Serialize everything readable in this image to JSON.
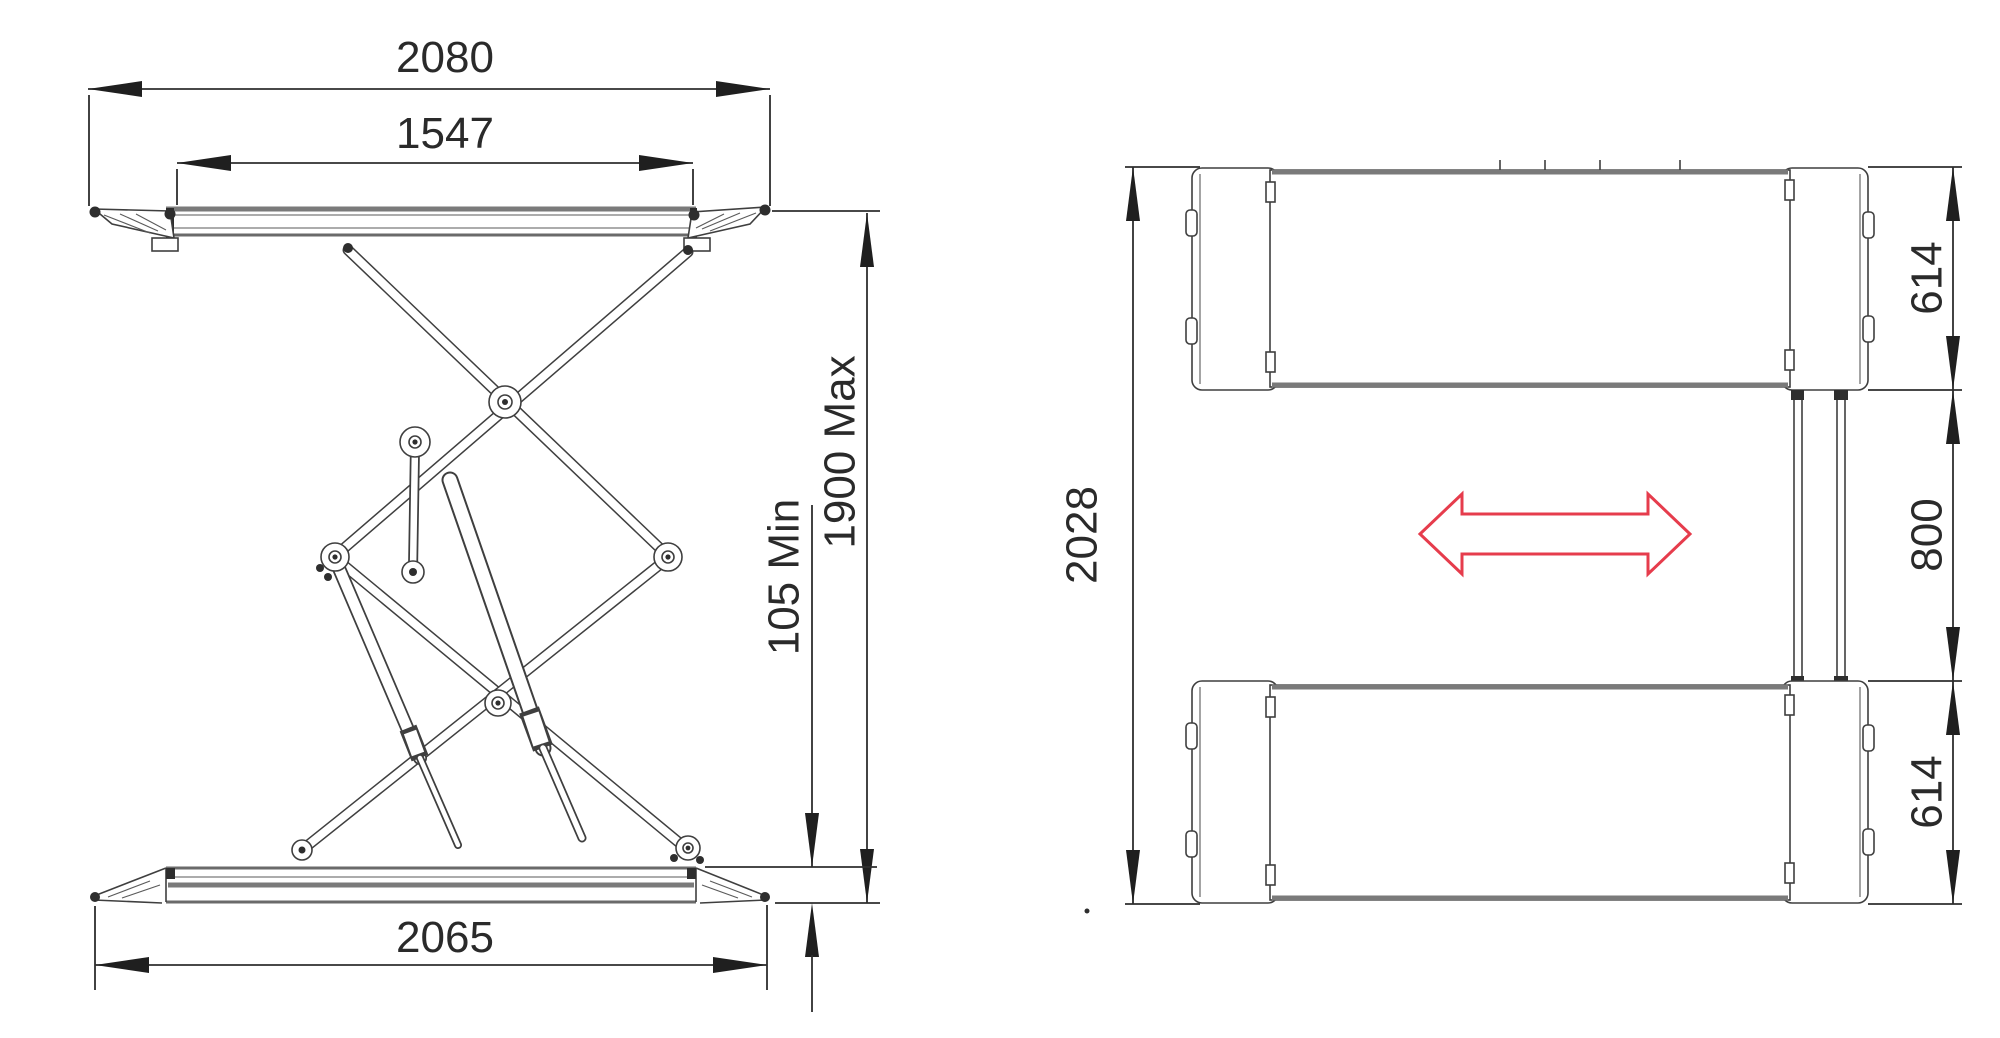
{
  "drawing": {
    "type": "scissor-car-lift-technical-drawing",
    "colors": {
      "line": "#3f3f3f",
      "thick_edge": "#7a7a7a",
      "dimension": "#2e2e2e",
      "text": "#2a2a2a",
      "accent_red": "#e63c4c",
      "background": "#ffffff"
    },
    "side_view": {
      "dims": {
        "top_width": "2080",
        "platform_length": "1547",
        "max_height": "1900 Max",
        "min_height": "105 Min",
        "base_length": "2065"
      }
    },
    "plan_view": {
      "dims": {
        "overall_length": "2028",
        "platform_width_top": "614",
        "center_gap": "800",
        "platform_width_bottom": "614"
      }
    }
  }
}
